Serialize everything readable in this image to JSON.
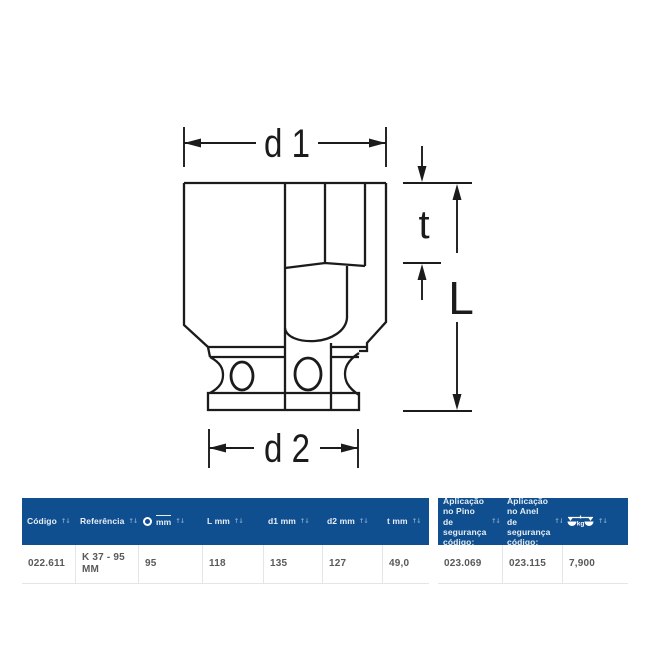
{
  "diagram": {
    "type": "socket-cross-section",
    "labels": {
      "d1": "d 1",
      "t": "t",
      "L": "L",
      "d2": "d 2"
    },
    "stroke_color": "#1b1b1b"
  },
  "table": {
    "header_bg": "#104f8f",
    "header_text_color": "#e7eef6",
    "row_text_color": "#58595b",
    "separator_color": "#e4e5e6",
    "sort_icon": "↑↓",
    "columns": [
      {
        "label": "Código"
      },
      {
        "label": "Referência"
      },
      {
        "label": "mm",
        "icon": "hex-ring-icon"
      },
      {
        "label": "L mm"
      },
      {
        "label": "d1 mm"
      },
      {
        "label": "d2 mm"
      },
      {
        "label": "t mm"
      },
      {
        "label": "Aplicação no Pino de segurança código:"
      },
      {
        "label": "Aplicação no Anel de segurança código:"
      },
      {
        "label": "kg",
        "icon": "scale-icon"
      }
    ],
    "rows": [
      [
        "022.611",
        "K 37 - 95 MM",
        "95",
        "118",
        "135",
        "127",
        "49,0",
        "023.069",
        "023.115",
        "7,900"
      ]
    ]
  }
}
